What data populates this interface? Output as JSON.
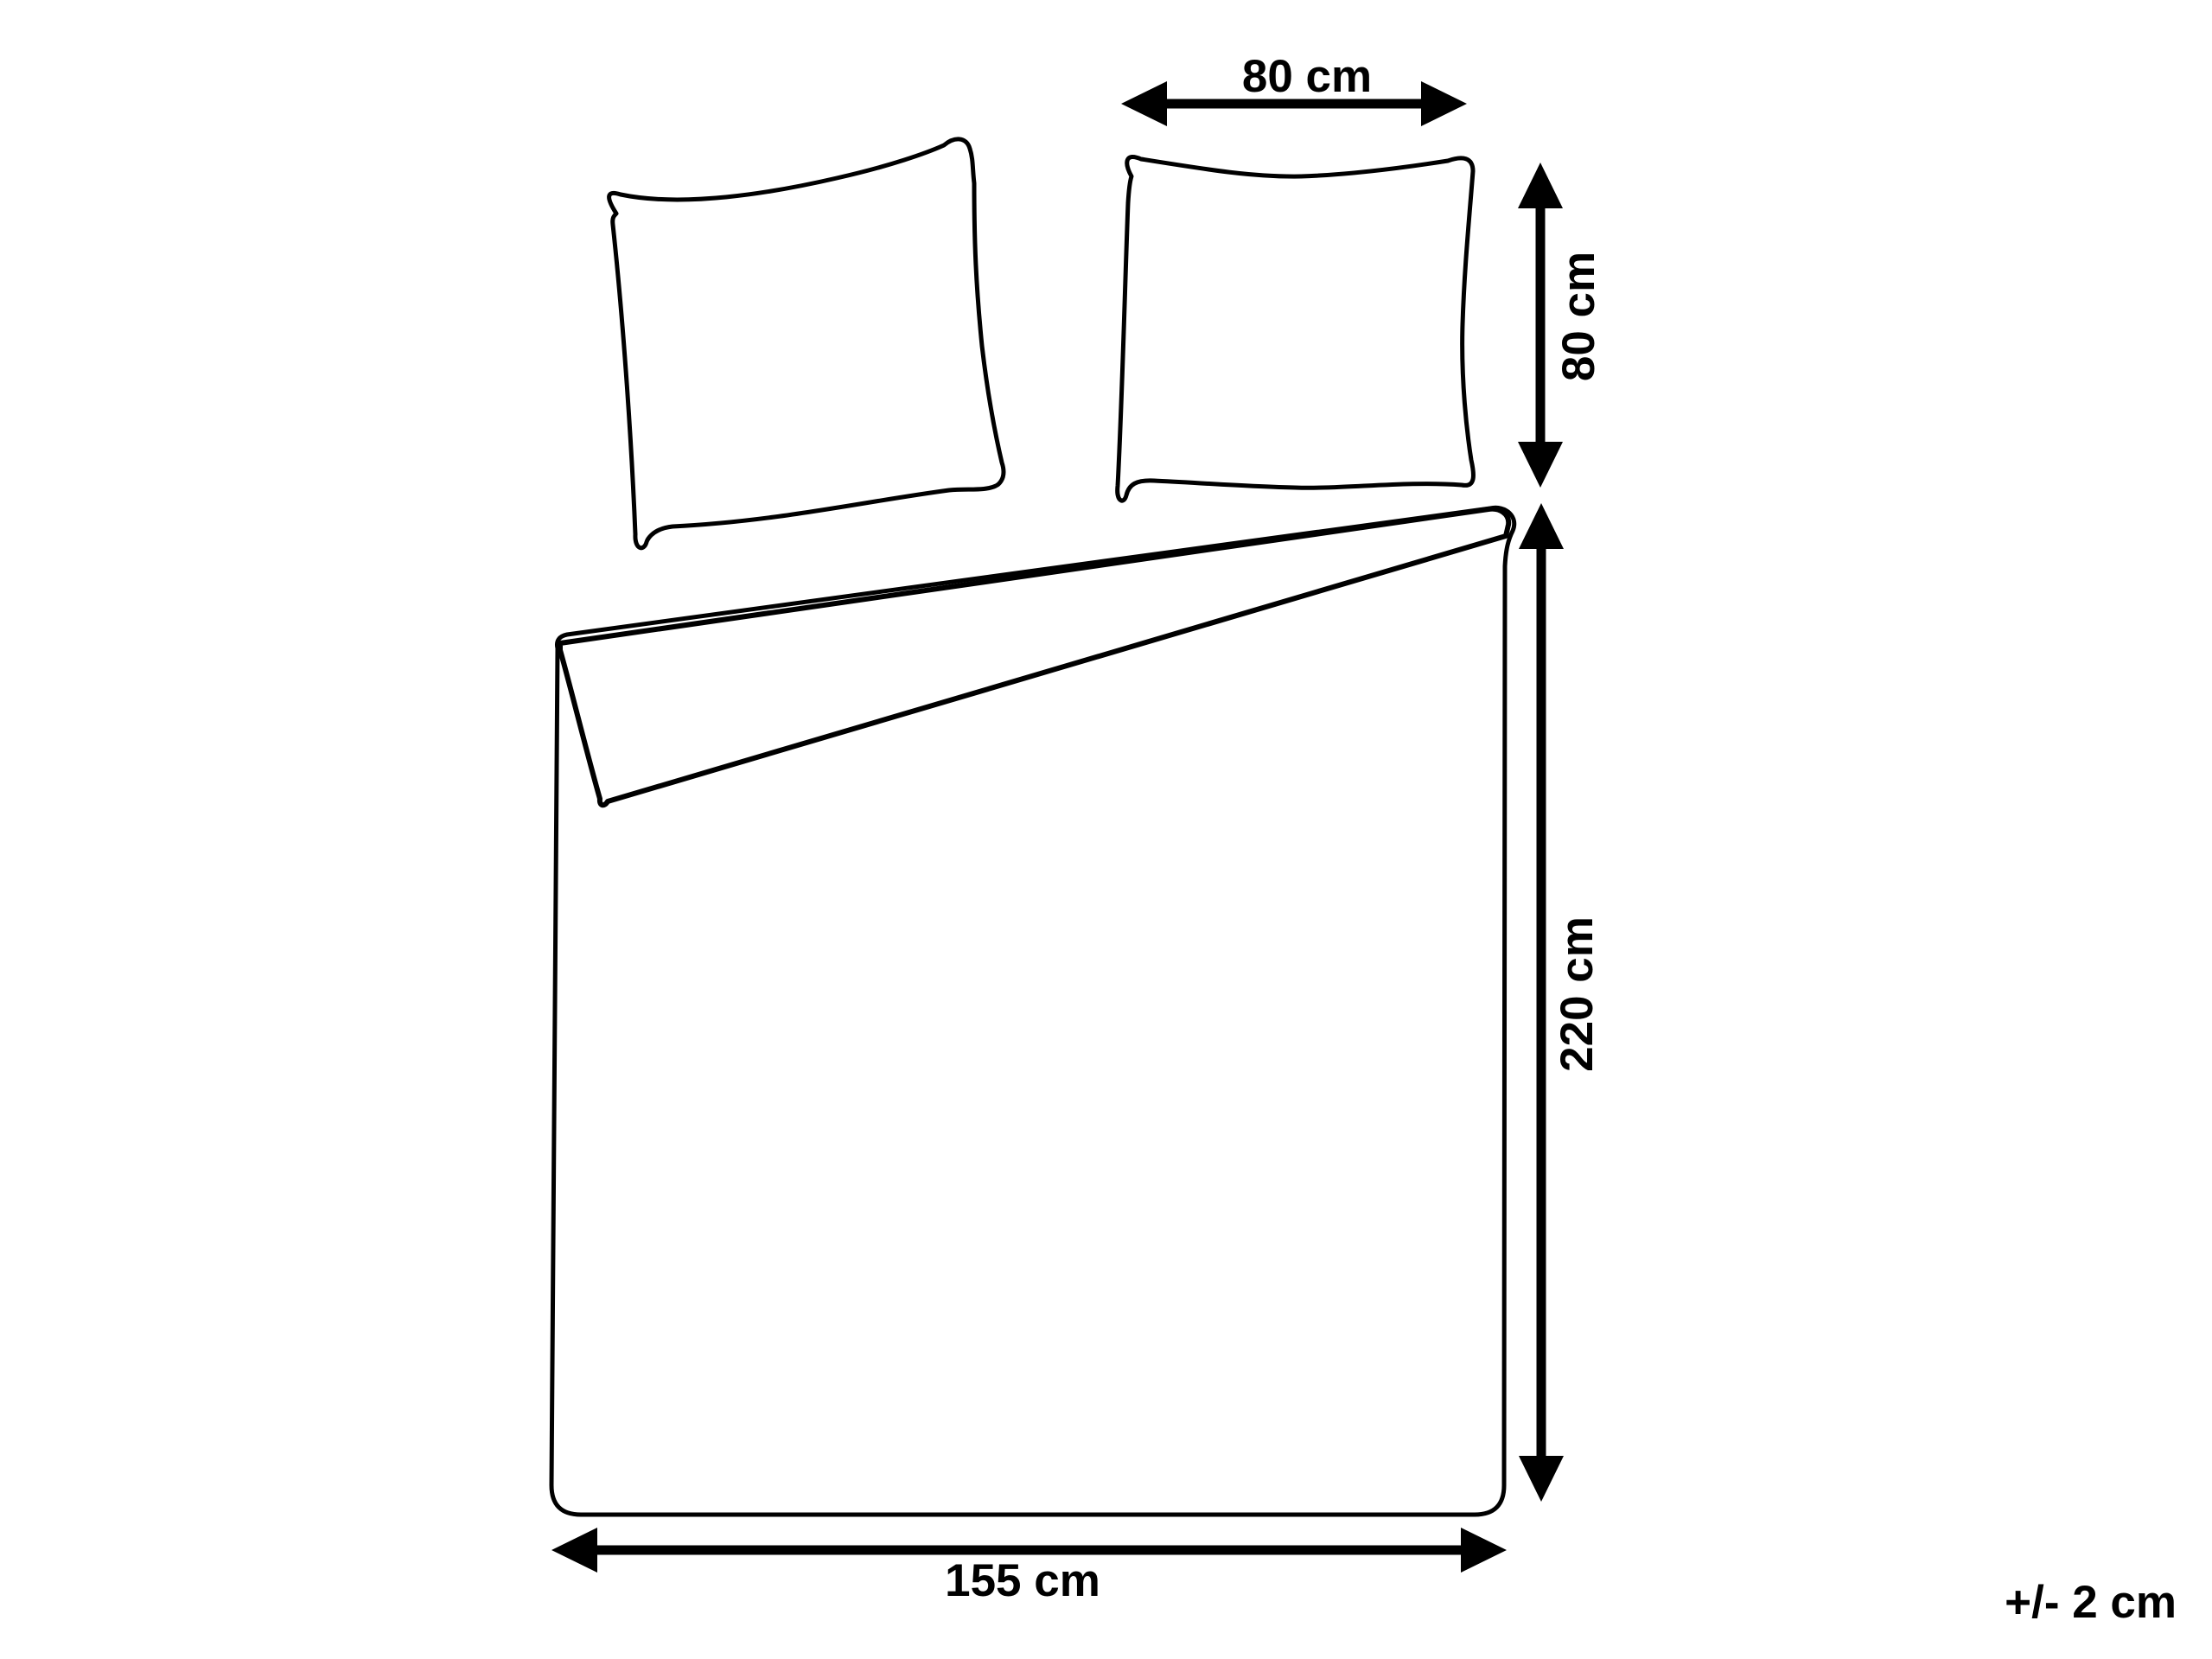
{
  "diagram": {
    "background_color": "#ffffff",
    "line_color": "#000000",
    "labels": {
      "pillow_width": "80 cm",
      "pillow_height": "80 cm",
      "duvet_length": "220 cm",
      "duvet_width": "155 cm",
      "tolerance": "+/- 2 cm"
    },
    "measurements": {
      "pillowcase": {
        "width_cm": 80,
        "height_cm": 80
      },
      "duvet_cover": {
        "width_cm": 155,
        "length_cm": 220
      },
      "tolerance_cm": 2
    }
  }
}
